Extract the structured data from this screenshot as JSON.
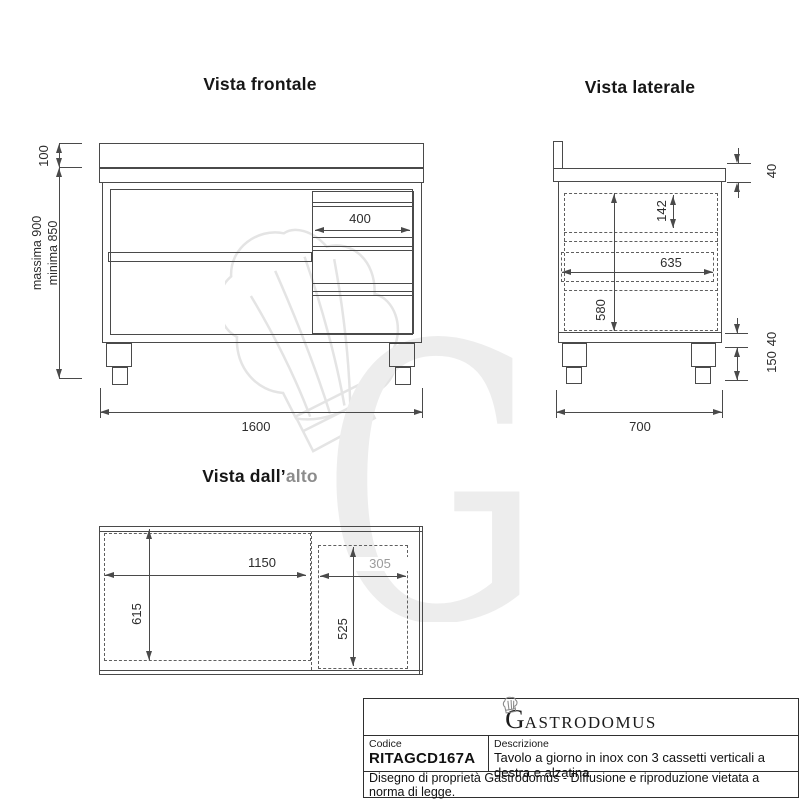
{
  "views": {
    "front": {
      "title": "Vista frontale",
      "dim_top": "100",
      "dim_min": "minima 850",
      "dim_max": "massima 900",
      "dim_drawer": "400",
      "dim_width": "1600"
    },
    "side": {
      "title": "Vista laterale",
      "dim_worktop": "40",
      "dim_drawer_h": "142",
      "dim_inner_d": "635",
      "dim_inner_h": "580",
      "dim_base": "40",
      "dim_leg": "150",
      "dim_depth": "700"
    },
    "top": {
      "title_main": "Vista dall’",
      "title_suffix": "alto",
      "dim_open_w": "1150",
      "dim_open_d": "615",
      "dim_drawer_w": "305",
      "dim_drawer_d": "525"
    }
  },
  "watermark": {
    "letter": "G"
  },
  "titleblock": {
    "brand_initial": "G",
    "brand_rest": "ASTRODOMUS",
    "code_label": "Codice",
    "code_value": "RITAGCD167A",
    "desc_label": "Descrizione",
    "desc_value": "Tavolo a giorno in inox con 3 cassetti verticali a destra e alzatina",
    "legal": "Disegno di proprietà Gastrodomus -  Diffusione e riproduzione vietata a norma di legge."
  },
  "colors": {
    "line": "#4a4a4a",
    "dim_text": "#2d2d2d",
    "gray_text": "#9b9b9b",
    "watermark": "#ededed"
  }
}
